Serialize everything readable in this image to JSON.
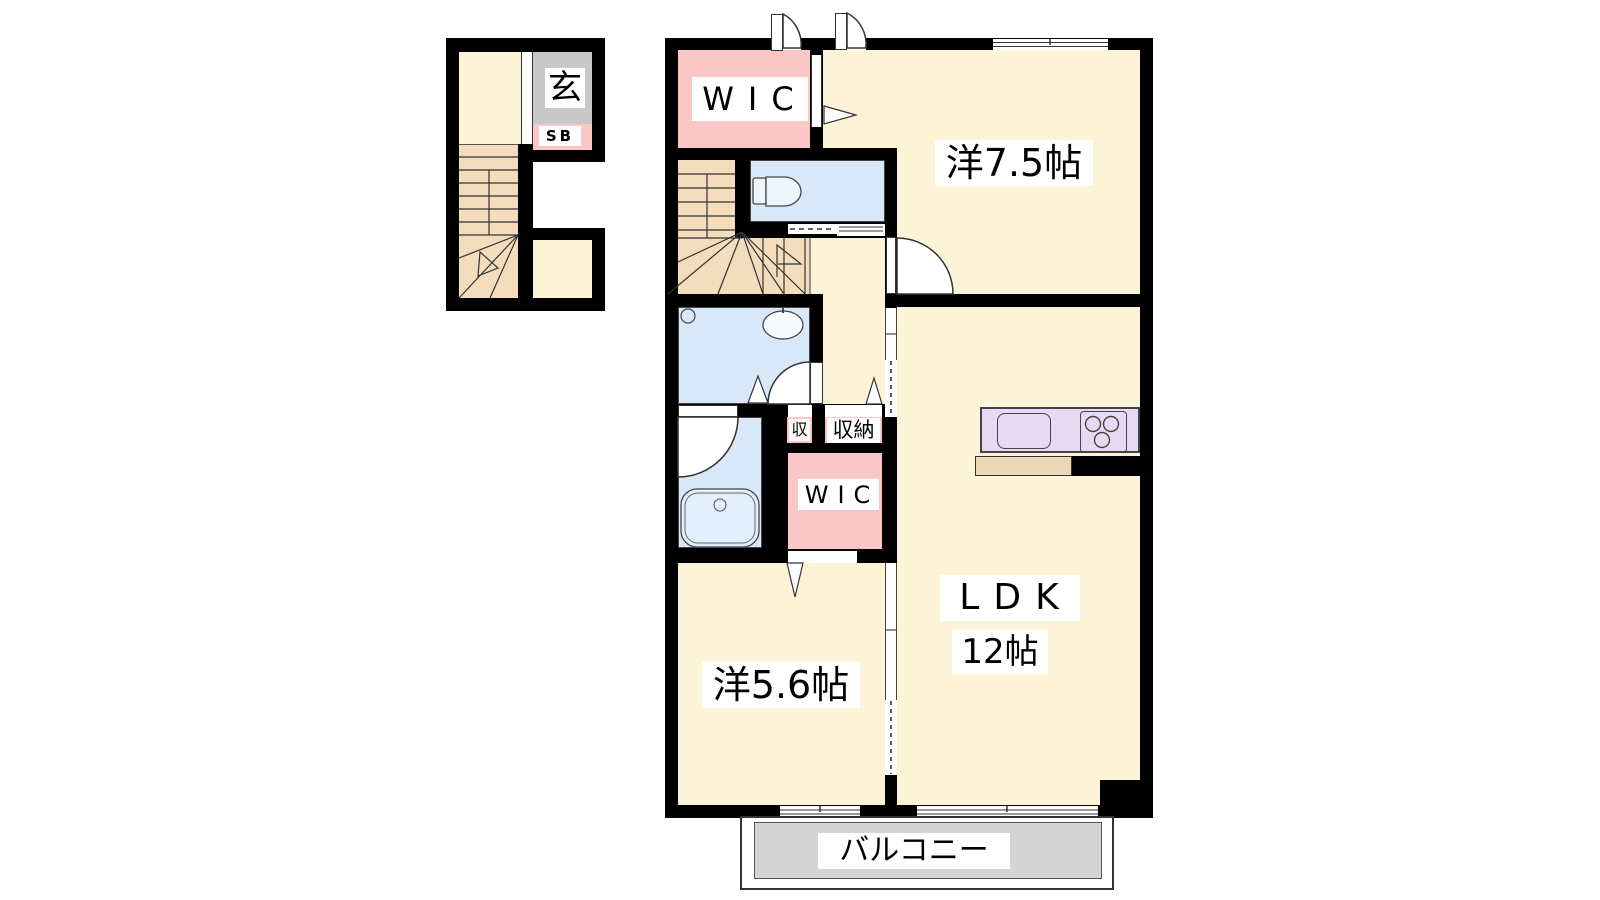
{
  "plan": {
    "title": "apartment-floor-plan",
    "labels": {
      "entrance": "玄",
      "shoe_box": "SB",
      "wic_upper": "WIC",
      "western_room_large": "洋7.5帖",
      "storage_small": "収",
      "storage": "収納",
      "wic_lower": "WIC",
      "western_room_small": "洋5.6帖",
      "ldk": "LDK",
      "ldk_size": "12帖",
      "balcony": "バルコニー"
    },
    "colors": {
      "wall": "#000000",
      "room_cream": "#fdf3d6",
      "stairs_tan": "#f3ddbc",
      "closet_pink": "#fbc6c6",
      "wet_area_blue": "#d8e8f8",
      "kitchen_lavender": "#e7dbf3",
      "entrance_gray": "#c8c8c8",
      "balcony_gray": "#d5d5d5"
    }
  }
}
